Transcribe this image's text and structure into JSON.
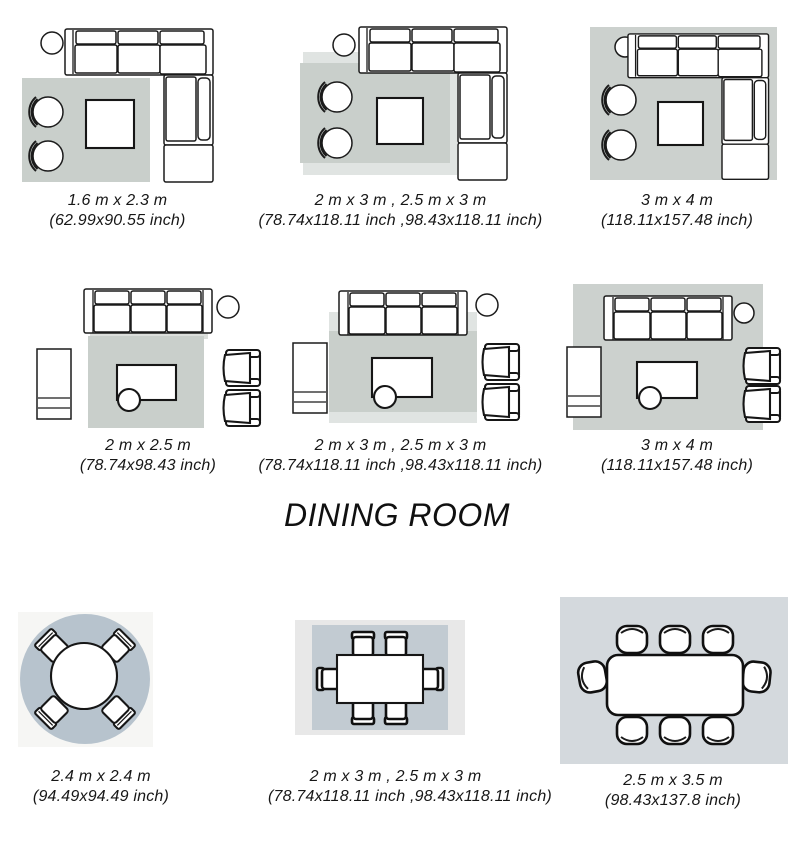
{
  "sections": {
    "dining_heading": "DINING ROOM"
  },
  "colors": {
    "page_bg": "#ffffff",
    "line_ink": "#1b1b1b",
    "text": "#171717",
    "living_rug": "#c9cfcb",
    "layered_rug_light": "#e0e4e2",
    "dining_round_rug": "#b7c3cd",
    "dining_rect_rug": "#c2cbd2",
    "dining_photo_bg_light": "#e8e8e8",
    "dining_photo_bg_blue": "#d4d9dd"
  },
  "panels": [
    {
      "id": "living-corner-small",
      "room": "living room",
      "furniture": [
        "corner-sofa",
        "barrel-chair",
        "barrel-chair",
        "coffee-table",
        "plant"
      ],
      "rug_layout": "rug under chairs and coffee table beside sectional",
      "size_m": "1.6 m x 2.3 m",
      "size_inch": "(62.99x90.55 inch)"
    },
    {
      "id": "living-corner-medium",
      "room": "living room",
      "furniture": [
        "corner-sofa",
        "barrel-chair",
        "barrel-chair",
        "coffee-table",
        "plant"
      ],
      "rug_layout": "two layered rugs reaching under sectional front",
      "size_m": "2 m x 3 m , 2.5 m x 3 m",
      "size_inch": "(78.74x118.11 inch ,98.43x118.11 inch)"
    },
    {
      "id": "living-corner-large",
      "room": "living room",
      "furniture": [
        "corner-sofa",
        "barrel-chair",
        "barrel-chair",
        "coffee-table",
        "plant"
      ],
      "rug_layout": "large rug under all furniture",
      "size_m": "3 m x 4 m",
      "size_inch": "(118.11x157.48 inch)"
    },
    {
      "id": "living-sofa-small",
      "room": "living room",
      "furniture": [
        "three-seat-sofa",
        "sideboard",
        "armchair",
        "armchair",
        "coffee-table",
        "side-table",
        "plant"
      ],
      "rug_layout": "rug between sofa and armchairs only",
      "size_m": "2 m x 2.5 m",
      "size_inch": "(78.74x98.43 inch)"
    },
    {
      "id": "living-sofa-medium",
      "room": "living room",
      "furniture": [
        "three-seat-sofa",
        "sideboard",
        "armchair",
        "armchair",
        "coffee-table",
        "side-table",
        "plant"
      ],
      "rug_layout": "two layered rugs reaching under sofa front",
      "size_m": "2 m x 3 m , 2.5 m x 3 m",
      "size_inch": "(78.74x118.11 inch ,98.43x118.11 inch)"
    },
    {
      "id": "living-sofa-large",
      "room": "living room",
      "furniture": [
        "three-seat-sofa",
        "sideboard",
        "armchair",
        "armchair",
        "coffee-table",
        "side-table",
        "plant"
      ],
      "rug_layout": "large rug under all furniture",
      "size_m": "3 m x 4 m",
      "size_inch": "(118.11x157.48 inch)"
    },
    {
      "id": "dining-round",
      "room": "dining room",
      "furniture": [
        "round-table",
        "dining-chair",
        "dining-chair",
        "dining-chair",
        "dining-chair"
      ],
      "rug_layout": "round rug under round table for four",
      "size_m": "2.4 m x 2.4 m",
      "size_inch": "(94.49x94.49 inch)"
    },
    {
      "id": "dining-six-seat",
      "room": "dining room",
      "furniture": [
        "rectangular-table",
        "dining-chair",
        "dining-chair",
        "dining-chair",
        "dining-chair",
        "dining-chair",
        "dining-chair"
      ],
      "rug_layout": "rectangular rug under six-seat table",
      "size_m": "2 m x 3 m , 2.5 m x 3 m",
      "size_inch": "(78.74x118.11 inch ,98.43x118.11 inch)"
    },
    {
      "id": "dining-eight-seat",
      "room": "dining room",
      "furniture": [
        "rectangular-table",
        "dining-chair",
        "dining-chair",
        "dining-chair",
        "dining-chair",
        "dining-chair",
        "dining-chair",
        "dining-chair",
        "dining-chair"
      ],
      "rug_layout": "large rug under eight-seat table",
      "size_m": "2.5 m x 3.5 m",
      "size_inch": "(98.43x137.8 inch)"
    }
  ]
}
